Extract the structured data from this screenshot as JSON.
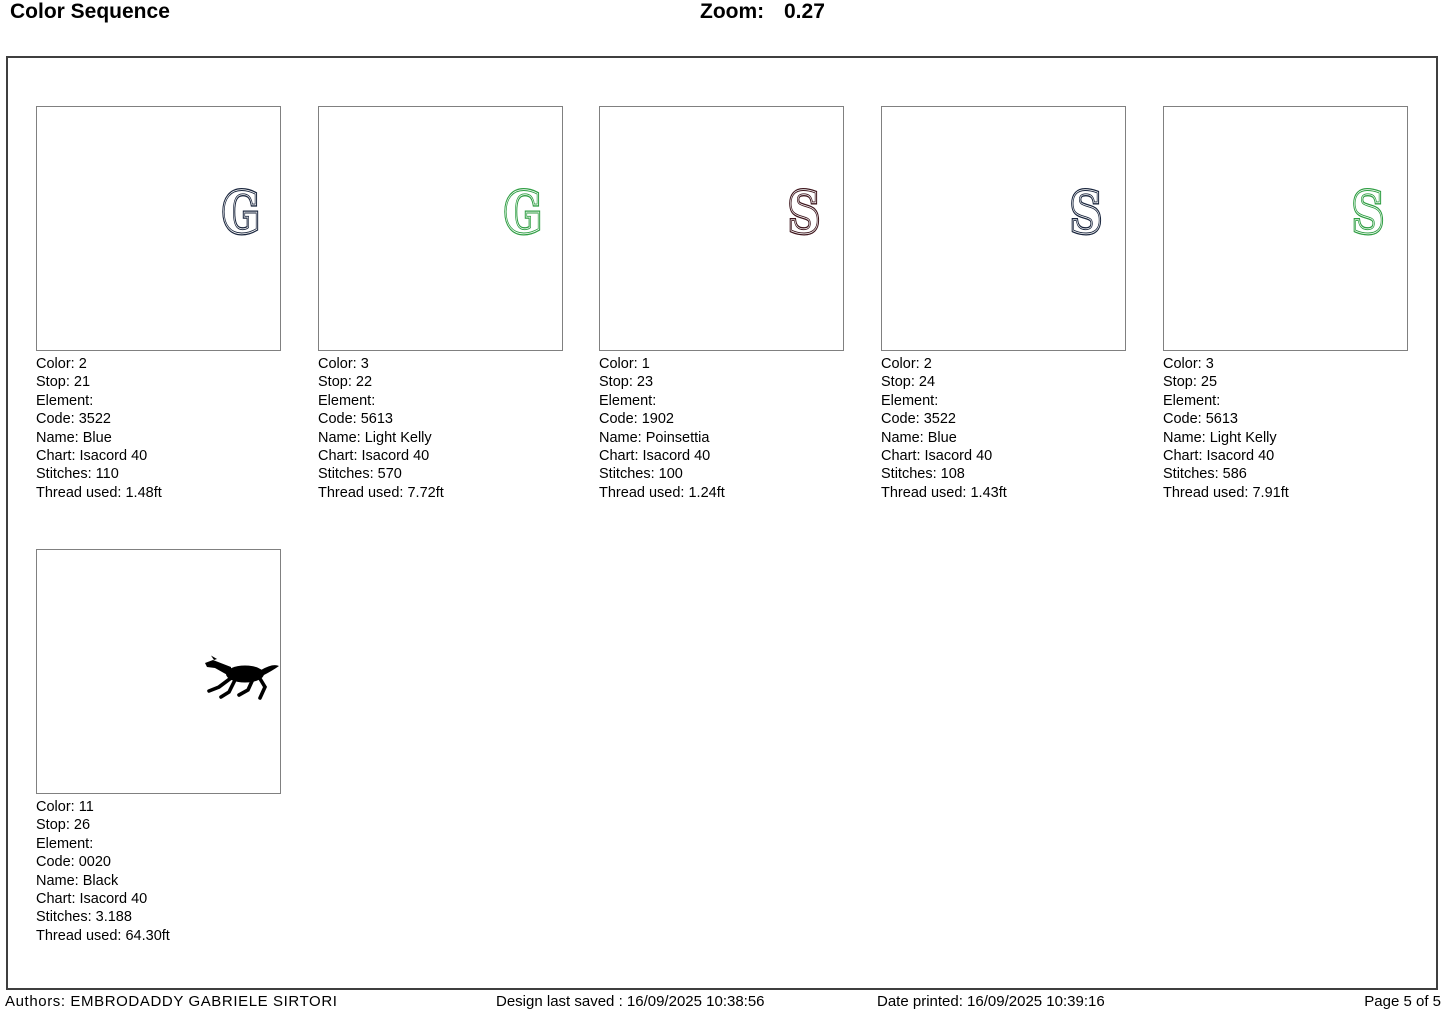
{
  "header": {
    "title": "Color Sequence",
    "zoom_label": "Zoom:",
    "zoom_value": "0.27"
  },
  "cards": [
    {
      "glyph": "G",
      "glyph_color": "#18243c",
      "color": "Color: 2",
      "stop": "Stop: 21",
      "element": "Element:",
      "code": "Code: 3522",
      "name": "Name: Blue",
      "chart": "Chart: Isacord 40",
      "stitches": "Stitches: 110",
      "thread": "Thread used: 1.48ft"
    },
    {
      "glyph": "G",
      "glyph_color": "#2f9e43",
      "color": "Color: 3",
      "stop": "Stop: 22",
      "element": "Element:",
      "code": "Code: 5613",
      "name": "Name: Light Kelly",
      "chart": "Chart: Isacord 40",
      "stitches": "Stitches: 570",
      "thread": "Thread used: 7.72ft"
    },
    {
      "glyph": "S",
      "glyph_color": "#3c141b",
      "color": "Color: 1",
      "stop": "Stop: 23",
      "element": "Element:",
      "code": "Code: 1902",
      "name": "Name: Poinsettia",
      "chart": "Chart: Isacord 40",
      "stitches": "Stitches: 100",
      "thread": "Thread used: 1.24ft"
    },
    {
      "glyph": "S",
      "glyph_color": "#18243c",
      "color": "Color: 2",
      "stop": "Stop: 24",
      "element": "Element:",
      "code": "Code: 3522",
      "name": "Name: Blue",
      "chart": "Chart: Isacord 40",
      "stitches": "Stitches: 108",
      "thread": "Thread used: 1.43ft"
    },
    {
      "glyph": "S",
      "glyph_color": "#2f9e43",
      "color": "Color: 3",
      "stop": "Stop: 25",
      "element": "Element:",
      "code": "Code: 5613",
      "name": "Name: Light Kelly",
      "chart": "Chart: Isacord 40",
      "stitches": "Stitches: 586",
      "thread": "Thread used: 7.91ft"
    },
    {
      "glyph": "horse",
      "glyph_color": "#000000",
      "color": "Color: 11",
      "stop": "Stop: 26",
      "element": "Element:",
      "code": "Code: 0020",
      "name": "Name: Black",
      "chart": "Chart: Isacord 40",
      "stitches": "Stitches: 3.188",
      "thread": "Thread used: 64.30ft"
    }
  ],
  "footer": {
    "authors": "Authors: EMBRODADDY GABRIELE SIRTORI",
    "saved": "Design last saved : 16/09/2025 10:38:56",
    "printed": "Date printed: 16/09/2025 10:39:16",
    "page": "Page 5 of 5"
  }
}
